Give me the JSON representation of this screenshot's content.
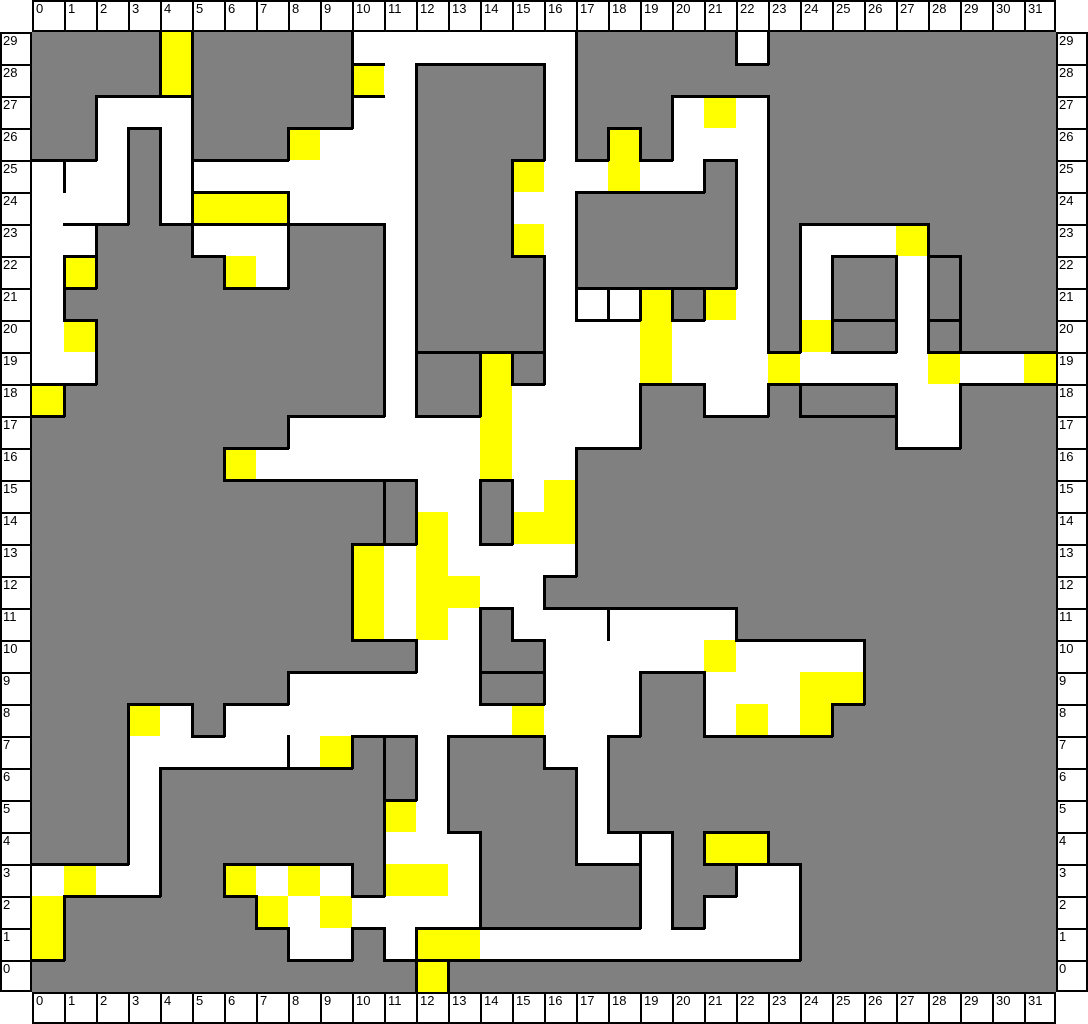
{
  "map": {
    "cols": 32,
    "rows": 30,
    "cell_px": 32,
    "colors": {
      "G": "#808080",
      "W": "#ffffff",
      "Y": "#ffff00",
      "line": "#000000"
    },
    "grid": [
      "GGGGYGGGGGWWWWWWWGGGGGWGGGGGGGGG",
      "GGGGYGGGGGYWGGGGWGGGGGGGGGGGGGGG",
      "GGWWWGGGGGWWGGGGWGGGWYWGGGGGGGGG",
      "GGWGWGGGYWWWGGGGWGYGWWWGGGGGGGGG",
      "WWWGWWWWWWWWGGGYWWYWWGWGGGGGGGGG",
      "WWWGWYYYWWWWGGGWWGGGGGWGGGGGGGGG",
      "WWGGGWWWGGGWGGGYWGGGGGWGWWWYGGGG",
      "WYGGGGYWGGGWGGGGWGGGGGWGWGGWGGGG",
      "WGGGGGGGGGGWGGGGWWWYGYWGWGGWGGGG",
      "WYGGGGGGGGGWGGGGWWWYWWWGYGGWGGGG",
      "WWGGGGGGGGGWGGYGWWWYWWWYWWWWYWWY",
      "YGGGGGGGGGGWGGYWWWWGGWWGGGGWWGGG",
      "GGGGGGGGWWWWWWYWWWWGGGGGGGGWWGGG",
      "GGGGGGYWWWWWWWYWWGGGGGGGGGGGGGGG",
      "GGGGGGGGGGGGWWGWYGGGGGGGGGGGGGGG",
      "GGGGGGGGGGGGYWGYYGGGGGGGGGGGGGGG",
      "GGGGGGGGGGYWYWWWWGGGGGGGGGGGGGGG",
      "GGGGGGGGGGYWYYWWGGGGGGGGGGGGGGGG",
      "GGGGGGGGGGYWYWGWWWWWWWGGGGGGGGGG",
      "GGGGGGGGGGGGWWGGWWWWWYWWWWGGGGGG",
      "GGGGGGGGWWWWWWGGWWWGGWWWYYGGGGGG",
      "GGGYWGWWWWWWWWWYWWWGGWYWYGGGGGGG",
      "GGGWWWWWWYGGWGGGWWGGGGGGGGGGGGGG",
      "GGGWGGGGGGGGWGGGGWGGGGGGGGGGGGGG",
      "GGGWGGGGGGGYWGGGGWGGGGGGGGGGGGGG",
      "GGGWGGGGGGGWWWGGGWWWGYYGGGGGGGGG",
      "WYWWGGYWYWGYYWGGGGGWGGWWGGGGGGGG",
      "YGGGGGGYWYWWWWGGGGGWGWWWGGGGGGGG",
      "YGGGGGGGWWGWYYWWWWWWWWWWGGGGGGGG",
      "GGGGGGGGGGGGYGGGGGGGGGGGGGGGGGGG"
    ],
    "walls_h": [
      {
        "x": 32,
        "y": 192,
        "len": 32
      },
      {
        "x": 160,
        "y": 160,
        "len": 96
      },
      {
        "x": 160,
        "y": 192,
        "len": 96
      },
      {
        "x": 768,
        "y": 384,
        "len": 96
      },
      {
        "x": 640,
        "y": 256,
        "len": 32
      },
      {
        "x": 896,
        "y": 224,
        "len": 32
      },
      {
        "x": 896,
        "y": 288,
        "len": 32
      },
      {
        "x": 800,
        "y": 288,
        "len": 64
      },
      {
        "x": 544,
        "y": 288,
        "len": 64
      },
      {
        "x": 384,
        "y": 320,
        "len": 64
      },
      {
        "x": 480,
        "y": 320,
        "len": 32
      },
      {
        "x": 320,
        "y": 32,
        "len": 32
      },
      {
        "x": 320,
        "y": 64,
        "len": 32
      },
      {
        "x": 128,
        "y": 64,
        "len": 32
      },
      {
        "x": 0,
        "y": 352,
        "len": 32
      },
      {
        "x": 448,
        "y": 640,
        "len": 64
      },
      {
        "x": 800,
        "y": 672,
        "len": 32
      },
      {
        "x": 704,
        "y": 832,
        "len": 32
      },
      {
        "x": 384,
        "y": 896,
        "len": 64
      },
      {
        "x": 384,
        "y": 928,
        "len": 32
      },
      {
        "x": 32,
        "y": 224,
        "len": 32
      }
    ],
    "walls_v": [
      {
        "x": 32,
        "y": 128,
        "len": 32
      },
      {
        "x": 160,
        "y": 128,
        "len": 32
      },
      {
        "x": 160,
        "y": 160,
        "len": 32
      },
      {
        "x": 256,
        "y": 160,
        "len": 32
      },
      {
        "x": 768,
        "y": 352,
        "len": 32
      },
      {
        "x": 928,
        "y": 224,
        "len": 64
      },
      {
        "x": 928,
        "y": 288,
        "len": 32
      },
      {
        "x": 544,
        "y": 256,
        "len": 32
      },
      {
        "x": 576,
        "y": 256,
        "len": 32
      },
      {
        "x": 608,
        "y": 256,
        "len": 32
      },
      {
        "x": 576,
        "y": 576,
        "len": 32
      },
      {
        "x": 256,
        "y": 704,
        "len": 32
      },
      {
        "x": 352,
        "y": 704,
        "len": 64
      },
      {
        "x": 352,
        "y": 448,
        "len": 64
      },
      {
        "x": 608,
        "y": 800,
        "len": 32
      },
      {
        "x": 384,
        "y": 896,
        "len": 32
      },
      {
        "x": 32,
        "y": 224,
        "len": 32
      }
    ]
  },
  "axes": {
    "top": [
      "0",
      "1",
      "2",
      "3",
      "4",
      "5",
      "6",
      "7",
      "8",
      "9",
      "10",
      "11",
      "12",
      "13",
      "14",
      "15",
      "16",
      "17",
      "18",
      "19",
      "20",
      "21",
      "22",
      "23",
      "24",
      "25",
      "26",
      "27",
      "28",
      "29",
      "30",
      "31"
    ],
    "bottom": [
      "0",
      "1",
      "2",
      "3",
      "4",
      "5",
      "6",
      "7",
      "8",
      "9",
      "10",
      "11",
      "12",
      "13",
      "14",
      "15",
      "16",
      "17",
      "18",
      "19",
      "20",
      "21",
      "22",
      "23",
      "24",
      "25",
      "26",
      "27",
      "28",
      "29",
      "30",
      "31"
    ],
    "left": [
      "29",
      "28",
      "27",
      "26",
      "25",
      "24",
      "23",
      "22",
      "21",
      "20",
      "19",
      "18",
      "17",
      "16",
      "15",
      "14",
      "13",
      "12",
      "11",
      "10",
      "9",
      "8",
      "7",
      "6",
      "5",
      "4",
      "3",
      "2",
      "1",
      "0"
    ],
    "right": [
      "29",
      "28",
      "27",
      "26",
      "25",
      "24",
      "23",
      "22",
      "21",
      "20",
      "19",
      "18",
      "17",
      "16",
      "15",
      "14",
      "13",
      "12",
      "11",
      "10",
      "9",
      "8",
      "7",
      "6",
      "5",
      "4",
      "3",
      "2",
      "1",
      "0"
    ]
  }
}
